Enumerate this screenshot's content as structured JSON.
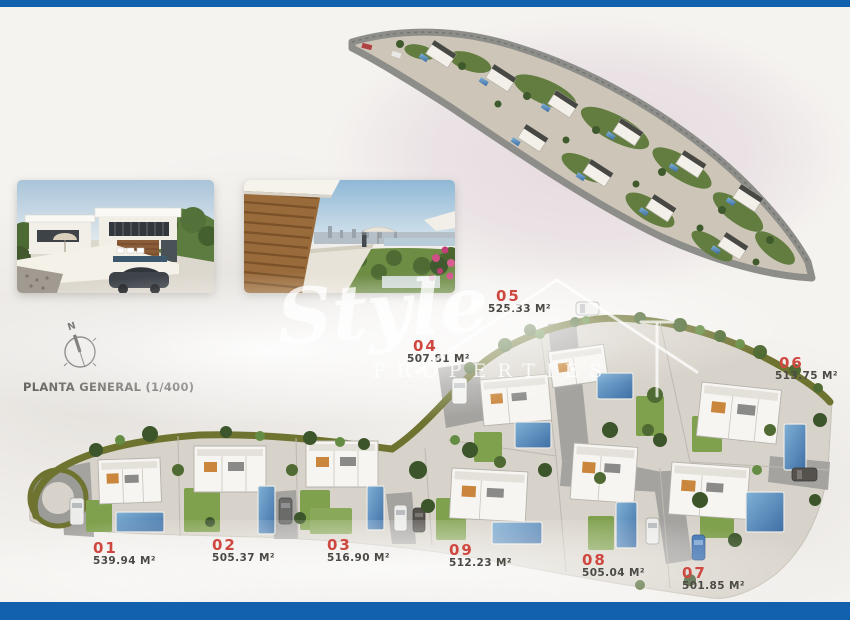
{
  "page": {
    "type": "development-site-plan-brochure"
  },
  "colors": {
    "border_bar": "#1261ae",
    "plot_number": "#cf4840",
    "plot_area_text": "#4b4a45",
    "background": "#f5f3f0",
    "hedge_green": "#6f7330",
    "pool_blue": "#4e86b8"
  },
  "site_plan": {
    "title": "PLANTA GENERAL (1/400)",
    "compass_north_label": "N",
    "plots": [
      {
        "id": "01",
        "area": "539.94 M²"
      },
      {
        "id": "02",
        "area": "505.37 M²"
      },
      {
        "id": "03",
        "area": "516.90 M²"
      },
      {
        "id": "04",
        "area": "507.81 M²"
      },
      {
        "id": "05",
        "area": "525.33 M²"
      },
      {
        "id": "06",
        "area": "513.75 M²"
      },
      {
        "id": "07",
        "area": "501.85 M²"
      },
      {
        "id": "08",
        "area": "505.04 M²"
      },
      {
        "id": "09",
        "area": "512.23 M²"
      }
    ]
  },
  "watermark": {
    "brand_script": "Style",
    "brand_sub": "PROPERTIES"
  }
}
